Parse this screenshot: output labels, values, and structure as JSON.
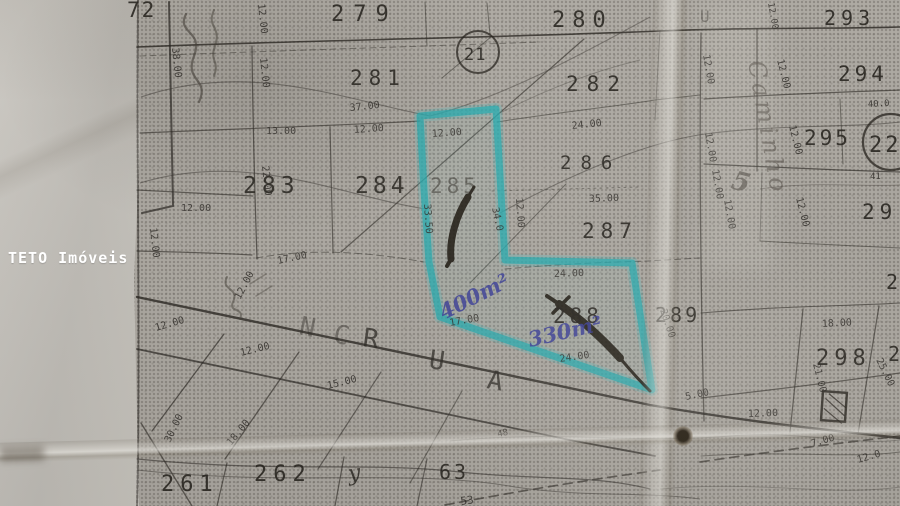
{
  "watermark": {
    "label": "TETO Imóveis",
    "color": "#ffffff"
  },
  "map": {
    "kind": "cadastral-plat-photo",
    "street_name": "RUA",
    "highlight": {
      "marker_color": "#1fb3b8",
      "highlighted_lots": [
        "285",
        "288"
      ],
      "handwritten_area_1": "400m²",
      "handwritten_area_2": "330m²",
      "pen_color": "#3b3f9e"
    },
    "lot_numbers_visible": [
      "72",
      "279",
      "280",
      "293",
      "281",
      "282",
      "294",
      "295",
      "22",
      "21",
      "283",
      "284",
      "285",
      "286",
      "287",
      "288",
      "289",
      "29",
      "2",
      "298",
      "261",
      "262",
      "63"
    ],
    "labels": [
      {
        "t": "72",
        "x": 127,
        "y": 17,
        "s": 21,
        "c": "lot",
        "ls": 2
      },
      {
        "t": "279",
        "x": 331,
        "y": 21,
        "s": 22,
        "c": "lot",
        "ls": 9
      },
      {
        "t": "280",
        "x": 552,
        "y": 27,
        "s": 22,
        "c": "lot",
        "ls": 7
      },
      {
        "t": "293",
        "x": 824,
        "y": 25,
        "s": 20,
        "c": "lot",
        "ls": 5
      },
      {
        "t": "281",
        "x": 350,
        "y": 85,
        "s": 21,
        "c": "lot",
        "ls": 6
      },
      {
        "t": "282",
        "x": 566,
        "y": 91,
        "s": 21,
        "c": "lot",
        "ls": 8
      },
      {
        "t": "294",
        "x": 838,
        "y": 81,
        "s": 21,
        "c": "lot",
        "ls": 4
      },
      {
        "t": "295",
        "x": 804,
        "y": 145,
        "s": 21,
        "c": "lot",
        "ls": 3
      },
      {
        "t": "22",
        "x": 869,
        "y": 152,
        "s": 22,
        "c": "lot",
        "ls": 3
      },
      {
        "t": "21",
        "x": 464,
        "y": 60,
        "s": 17,
        "c": "lot",
        "ls": 1
      },
      {
        "t": "283",
        "x": 243,
        "y": 193,
        "s": 23,
        "c": "lot",
        "ls": 5
      },
      {
        "t": "284",
        "x": 355,
        "y": 193,
        "s": 23,
        "c": "lot",
        "ls": 4
      },
      {
        "t": "285",
        "x": 430,
        "y": 193,
        "s": 21,
        "c": "lotf",
        "ls": 4
      },
      {
        "t": "286",
        "x": 560,
        "y": 169,
        "s": 19,
        "c": "lot",
        "ls": 9
      },
      {
        "t": "287",
        "x": 582,
        "y": 238,
        "s": 21,
        "c": "lot",
        "ls": 6
      },
      {
        "t": "288",
        "x": 553,
        "y": 323,
        "s": 21,
        "c": "lot",
        "ls": 4
      },
      {
        "t": "289",
        "x": 655,
        "y": 322,
        "s": 20,
        "c": "lot",
        "ls": 3
      },
      {
        "t": "29",
        "x": 862,
        "y": 219,
        "s": 21,
        "c": "lot",
        "ls": 5
      },
      {
        "t": "2",
        "x": 886,
        "y": 289,
        "s": 20,
        "c": "lot"
      },
      {
        "t": "298",
        "x": 816,
        "y": 365,
        "s": 22,
        "c": "lot",
        "ls": 5
      },
      {
        "t": "2",
        "x": 888,
        "y": 361,
        "s": 20,
        "c": "lot"
      },
      {
        "t": "261",
        "x": 161,
        "y": 491,
        "s": 22,
        "c": "lot",
        "ls": 6
      },
      {
        "t": "262",
        "x": 254,
        "y": 481,
        "s": 22,
        "c": "lot",
        "ls": 6
      },
      {
        "t": "63",
        "x": 439,
        "y": 479,
        "s": 20,
        "c": "lot",
        "ls": 3
      },
      {
        "t": "37.00",
        "x": 350,
        "y": 111,
        "r": -6,
        "c": "dim"
      },
      {
        "t": "13.00",
        "x": 266,
        "y": 134,
        "c": "dim"
      },
      {
        "t": "12.00",
        "x": 354,
        "y": 133,
        "r": -4,
        "c": "dim"
      },
      {
        "t": "12.00",
        "x": 432,
        "y": 137,
        "r": -4,
        "c": "dim"
      },
      {
        "t": "24.00",
        "x": 572,
        "y": 129,
        "r": -6,
        "c": "dim"
      },
      {
        "t": "35.00",
        "x": 589,
        "y": 202,
        "r": -2,
        "c": "dim"
      },
      {
        "t": "24.00",
        "x": 554,
        "y": 277,
        "r": -2,
        "c": "dim"
      },
      {
        "t": "24.00",
        "x": 560,
        "y": 362,
        "r": -8,
        "c": "dim"
      },
      {
        "t": "17.00",
        "x": 278,
        "y": 264,
        "r": -12,
        "c": "dim"
      },
      {
        "t": "17.00",
        "x": 450,
        "y": 326,
        "r": -10,
        "c": "dim"
      },
      {
        "t": "12.00",
        "x": 181,
        "y": 211,
        "c": "dim"
      },
      {
        "t": "12.00",
        "x": 156,
        "y": 331,
        "r": -16,
        "c": "dim"
      },
      {
        "t": "12.00",
        "x": 241,
        "y": 356,
        "r": -14,
        "c": "dim"
      },
      {
        "t": "15.00",
        "x": 328,
        "y": 389,
        "r": -14,
        "c": "dim"
      },
      {
        "t": "18.00",
        "x": 231,
        "y": 446,
        "r": -50,
        "c": "dim"
      },
      {
        "t": "12.00",
        "x": 240,
        "y": 300,
        "r": -62,
        "c": "dim"
      },
      {
        "t": "30.00",
        "x": 170,
        "y": 443,
        "r": -64,
        "c": "dim"
      },
      {
        "t": "12.00",
        "x": 748,
        "y": 417,
        "r": -2,
        "c": "dim"
      },
      {
        "t": "18.00",
        "x": 822,
        "y": 327,
        "r": -3,
        "c": "dim"
      },
      {
        "t": "7.00",
        "x": 812,
        "y": 447,
        "r": -16,
        "c": "dim"
      },
      {
        "t": "12.0",
        "x": 858,
        "y": 463,
        "r": -16,
        "c": "dim"
      },
      {
        "t": "21.00",
        "x": 813,
        "y": 364,
        "r": 76,
        "c": "dim"
      },
      {
        "t": "25.00",
        "x": 876,
        "y": 360,
        "r": 64,
        "c": "dim"
      },
      {
        "t": "5.00",
        "x": 686,
        "y": 400,
        "r": -12,
        "c": "dim"
      },
      {
        "t": "48",
        "x": 498,
        "y": 437,
        "r": -12,
        "s": 9,
        "c": "dim"
      },
      {
        "t": "40.0",
        "x": 868,
        "y": 107,
        "r": -3,
        "s": 9,
        "c": "dim"
      },
      {
        "t": "41",
        "x": 870,
        "y": 179,
        "s": 9,
        "c": "dim"
      },
      {
        "t": "38.00",
        "x": 172,
        "y": 48,
        "r": 84,
        "c": "dim"
      },
      {
        "t": "12.00",
        "x": 258,
        "y": 4,
        "r": 84,
        "c": "dim"
      },
      {
        "t": "12.00",
        "x": 260,
        "y": 58,
        "r": 84,
        "c": "dim"
      },
      {
        "t": "12.00",
        "x": 703,
        "y": 55,
        "r": 80,
        "c": "dim"
      },
      {
        "t": "12.00",
        "x": 705,
        "y": 133,
        "r": 80,
        "c": "dim"
      },
      {
        "t": "12.00",
        "x": 712,
        "y": 170,
        "r": 80,
        "c": "dim"
      },
      {
        "t": "12.00",
        "x": 724,
        "y": 200,
        "r": 80,
        "c": "dim"
      },
      {
        "t": "12.00",
        "x": 777,
        "y": 60,
        "r": 76,
        "c": "dim"
      },
      {
        "t": "12.00",
        "x": 789,
        "y": 126,
        "r": 76,
        "c": "dim"
      },
      {
        "t": "12.00",
        "x": 796,
        "y": 198,
        "r": 76,
        "c": "dim"
      },
      {
        "t": "12.00",
        "x": 768,
        "y": 3,
        "r": 80,
        "s": 9,
        "c": "dim"
      },
      {
        "t": "12.00",
        "x": 150,
        "y": 228,
        "r": 84,
        "c": "dim"
      },
      {
        "t": "22.00",
        "x": 262,
        "y": 166,
        "r": 84,
        "c": "dim"
      },
      {
        "t": "33.50",
        "x": 424,
        "y": 204,
        "r": 86,
        "c": "dim"
      },
      {
        "t": "12.00",
        "x": 516,
        "y": 198,
        "r": 86,
        "c": "dim"
      },
      {
        "t": "34.0",
        "x": 492,
        "y": 208,
        "r": 78,
        "c": "dim"
      },
      {
        "t": "20.00",
        "x": 660,
        "y": 310,
        "r": 72,
        "c": "dim"
      },
      {
        "t": "53",
        "x": 461,
        "y": 505,
        "r": -8,
        "s": 11,
        "c": "dim"
      },
      {
        "t": "N",
        "x": 298,
        "y": 334,
        "r": 12,
        "c": "streetf"
      },
      {
        "t": "C",
        "x": 332,
        "y": 342,
        "r": 12,
        "c": "streetf"
      },
      {
        "t": "R",
        "x": 362,
        "y": 346,
        "r": 8,
        "c": "street"
      },
      {
        "t": "U",
        "x": 428,
        "y": 368,
        "r": 8,
        "c": "street"
      },
      {
        "t": "A",
        "x": 486,
        "y": 388,
        "r": 10,
        "c": "street"
      },
      {
        "t": "U",
        "x": 700,
        "y": 22,
        "s": 16,
        "c": "streetf"
      },
      {
        "t": "400m²",
        "x": 444,
        "y": 320,
        "r": -27,
        "s": 21,
        "c": "pen"
      },
      {
        "t": "330m²",
        "x": 530,
        "y": 347,
        "r": -13,
        "s": 21,
        "c": "pen"
      },
      {
        "t": "Caminho",
        "x": 748,
        "y": 62,
        "r": 80,
        "s": 24,
        "ls": 4,
        "c": "cursive"
      },
      {
        "t": "5",
        "x": 730,
        "y": 188,
        "r": 15,
        "s": 26,
        "c": "cursive2"
      },
      {
        "t": "y",
        "x": 349,
        "y": 481,
        "r": -8,
        "s": 22,
        "c": "ink-hand"
      }
    ]
  }
}
